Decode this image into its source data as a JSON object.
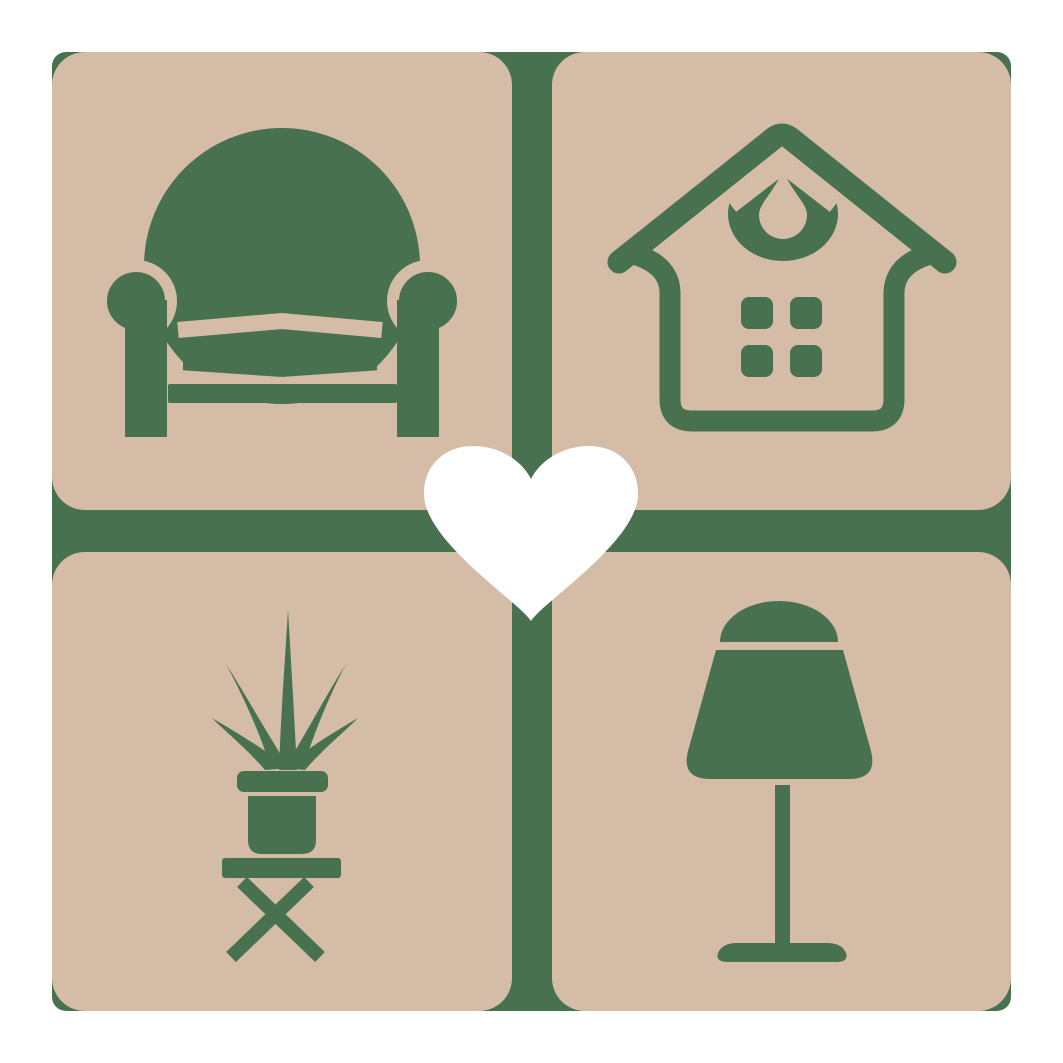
{
  "logo": {
    "name": "home-and-living-logo",
    "colors": {
      "background": "#ffffff",
      "tile": "#d5bca6",
      "green": "#48724f",
      "heart": "#ffffff"
    },
    "tiles": [
      {
        "id": "armchair",
        "icon": "armchair-icon"
      },
      {
        "id": "house",
        "icon": "house-icon"
      },
      {
        "id": "potted-plant",
        "icon": "potted-plant-icon"
      },
      {
        "id": "table-lamp",
        "icon": "table-lamp-icon"
      }
    ],
    "center_icon": "heart-icon"
  }
}
